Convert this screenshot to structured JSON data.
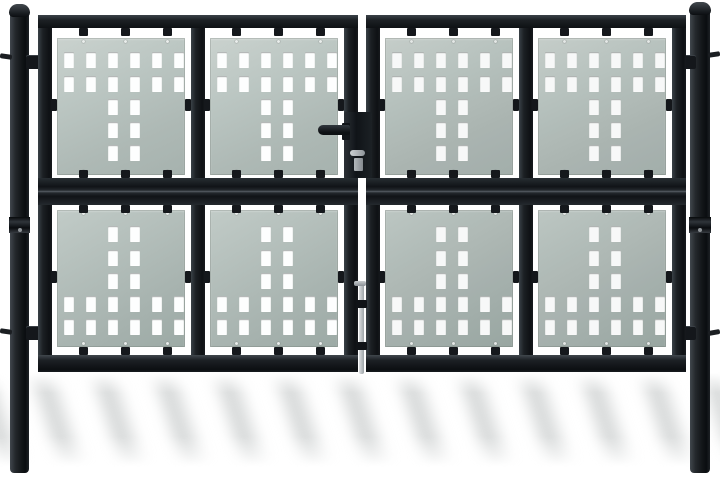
{
  "scene": {
    "description": "Product photograph of a black double-door garden fence gate: two round steel posts with domed caps, two gate leaves each holding four grey-green perforated metal infill panels, a centre lever latch with lock cylinder and a centre drop bolt, soft diagonal shadow bands on the white ground",
    "background_color": "#ffffff",
    "colors": {
      "frame": "#1b1f23",
      "frame_dark": "#0e1114",
      "frame_light": "#3a4147",
      "panel_top": "#b9c4c0",
      "panel_bottom": "#aab6b2",
      "hole": "#fdfefe",
      "hardware_metal": "#aeb3b7",
      "shadow_stripe": "#cdd0d0"
    },
    "panel_grid": {
      "leaves": 2,
      "columns_per_leaf": 2,
      "rows_per_leaf": 2,
      "total_panels": 8
    },
    "hole_pattern": {
      "columns_x": [
        7,
        29,
        51,
        73,
        95,
        117
      ],
      "tail_columns_x": [
        51,
        73
      ],
      "hole_w": 10,
      "hole_h": 16,
      "top_panel_rows": [
        {
          "y": 14,
          "type": "full"
        },
        {
          "y": 38,
          "type": "full"
        },
        {
          "y": 61,
          "type": "tail"
        },
        {
          "y": 84,
          "type": "tail"
        },
        {
          "y": 107,
          "type": "tail"
        }
      ],
      "bottom_panel_rows": [
        {
          "y": 16,
          "type": "tail"
        },
        {
          "y": 40,
          "type": "tail"
        },
        {
          "y": 63,
          "type": "tail"
        },
        {
          "y": 86,
          "type": "full"
        },
        {
          "y": 109,
          "type": "full"
        }
      ]
    },
    "geometry": {
      "gate": {
        "y": 15,
        "h": 357
      },
      "leaf_x": [
        38,
        366
      ],
      "leaf_w": 320,
      "stile_w": 14,
      "mullion_x": 153,
      "rail_top_h": 13,
      "rail_mid_y": 163,
      "rail_mid_h": 27,
      "rail_bot_y": 340,
      "rail_bot_h": 17,
      "panel_x": [
        19,
        172
      ],
      "panel_w": 128,
      "panel_top": {
        "y": 23,
        "h": 137
      },
      "panel_bottom": {
        "y": 195,
        "h": 137
      },
      "tab_x": [
        22,
        64,
        106
      ],
      "tab_w": 9,
      "tab_h": 8
    }
  }
}
